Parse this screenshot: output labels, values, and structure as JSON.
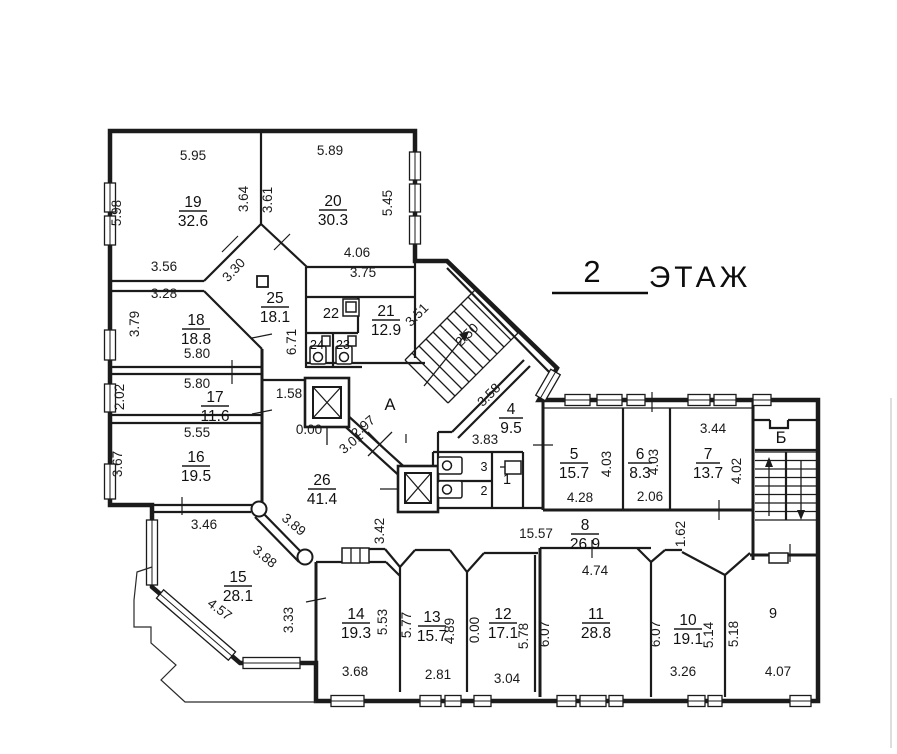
{
  "title": {
    "floor_number": "2",
    "floor_word": "ЭТАЖ"
  },
  "rooms": {
    "19": {
      "num": "19",
      "area": "32.6"
    },
    "20": {
      "num": "20",
      "area": "30.3"
    },
    "25": {
      "num": "25",
      "area": "18.1"
    },
    "21": {
      "num": "21",
      "area": "12.9"
    },
    "18": {
      "num": "18",
      "area": "18.8"
    },
    "17": {
      "num": "17",
      "area": "11.6"
    },
    "16": {
      "num": "16",
      "area": "19.5"
    },
    "26": {
      "num": "26",
      "area": "41.4"
    },
    "15": {
      "num": "15",
      "area": "28.1"
    },
    "14": {
      "num": "14",
      "area": "19.3"
    },
    "13": {
      "num": "13",
      "area": "15.7"
    },
    "12": {
      "num": "12",
      "area": "17.1"
    },
    "11": {
      "num": "11",
      "area": "28.8"
    },
    "10": {
      "num": "10",
      "area": "19.1"
    },
    "8": {
      "num": "8",
      "area": "26.9"
    },
    "4": {
      "num": "4",
      "area": "9.5"
    },
    "5": {
      "num": "5",
      "area": "15.7"
    },
    "6": {
      "num": "6",
      "area": "8.3"
    },
    "7": {
      "num": "7",
      "area": "13.7"
    }
  },
  "single_rooms": {
    "22": "22",
    "24": "24",
    "23": "23",
    "9": "9",
    "3": "3",
    "2": "2",
    "1": "1"
  },
  "letters": {
    "hall": "А",
    "stair": "Б",
    "mark": "I"
  },
  "dims": {
    "r19_top": "5.95",
    "r20_top": "5.89",
    "r19_left": "5.98",
    "r19_right": "3.64",
    "r20_left": "3.61",
    "r20_right": "5.45",
    "r20_bottom": "4.06",
    "r19_bottom": "3.56",
    "diag_25": "3.30",
    "r18_top": "3.28",
    "hall25_right": "3.75",
    "stair_upper": "3.51",
    "stair_width": "2.50",
    "stair_lower": "3.58",
    "r18_left": "3.79",
    "hall25_left": "6.71",
    "r18_bottom": "5.80",
    "r17_top": "5.80",
    "r17_left": "2.02",
    "lift_gap": "1.58",
    "r16_top": "5.55",
    "r16_left": "3.67",
    "level_a": "0.00",
    "hall_diag1": "2.97",
    "hall_diag2": "3.01",
    "wc_top": "3.83",
    "r7_top": "3.44",
    "r5_right": "4.03",
    "r6_right": "4.03",
    "r7_right": "4.02",
    "r5_bottom": "4.28",
    "r6_bottom": "2.06",
    "corridor_len": "15.57",
    "corridor_w": "1.62",
    "r15_top": "3.46",
    "r15_diag1": "3.89",
    "r15_diag2": "3.88",
    "r14_top": "3.42",
    "r15_sw": "4.57",
    "r15_right": "3.33",
    "r14_right": "5.53",
    "r13_left": "5.77",
    "r13_right": "4.89",
    "level_b": "0.00",
    "r12_right": "5.78",
    "r11_top": "4.74",
    "r11_left": "6.07",
    "r11_right": "6.07",
    "r10_right": "5.14",
    "r9_left": "5.18",
    "r13_bottom": "2.81",
    "r12_bottom": "3.04",
    "r14_bottom": "3.68",
    "r10_bottom": "3.26",
    "r9_bottom": "4.07"
  }
}
